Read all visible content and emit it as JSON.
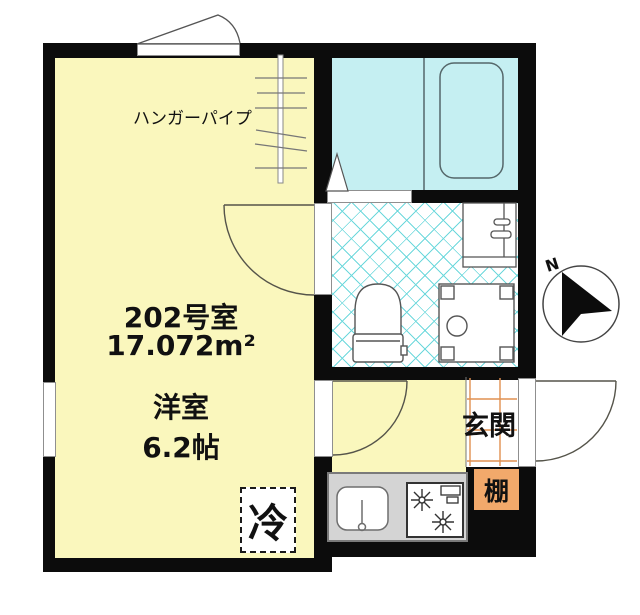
{
  "room": {
    "number": "202号室",
    "area": "17.072m²",
    "type": "洋室",
    "size": "6.2帖"
  },
  "labels": {
    "hanger_pipe": "ハンガーパイプ",
    "entrance": "玄関",
    "shelf": "棚",
    "refrigerator": "冷"
  },
  "compass": {
    "north": "N"
  },
  "colors": {
    "room_fill": "#FAF7BD",
    "bath_fill": "#C5EFF2",
    "lattice_line": "#6DD8DC",
    "shelf_fill": "#F2A96B",
    "entrance_grid_line": "#E09050",
    "counter_fill": "#D4D4D4",
    "wall": "#0C0C0C"
  }
}
